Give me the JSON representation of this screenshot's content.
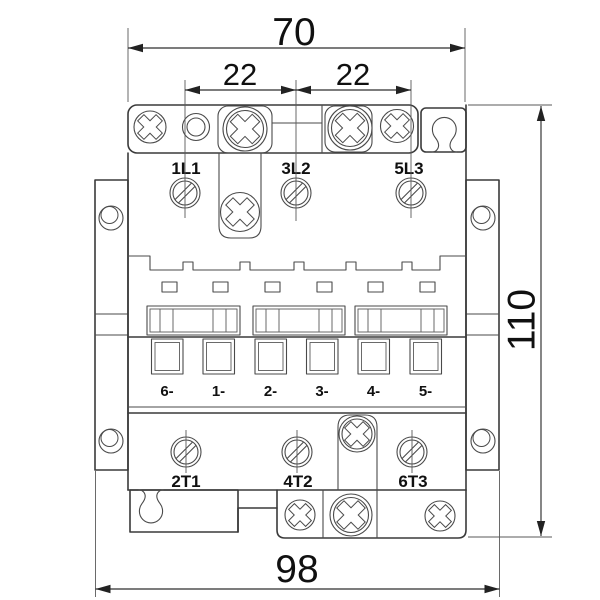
{
  "drawing": {
    "dimensions": {
      "top_width": "70",
      "pitch_left": "22",
      "pitch_right": "22",
      "height": "110",
      "bottom_width": "98"
    },
    "terminals": {
      "line": [
        "1L1",
        "3L2",
        "5L3"
      ],
      "load": [
        "2T1",
        "4T2",
        "6T3"
      ],
      "auxiliary": [
        "6-",
        "1-",
        "2-",
        "3-",
        "4-",
        "5-"
      ]
    },
    "colors": {
      "line": "#3a3a3a",
      "detail": "#4a4a4a",
      "dimension": "#2e2e2e",
      "text": "#101010",
      "background": "#ffffff"
    }
  }
}
